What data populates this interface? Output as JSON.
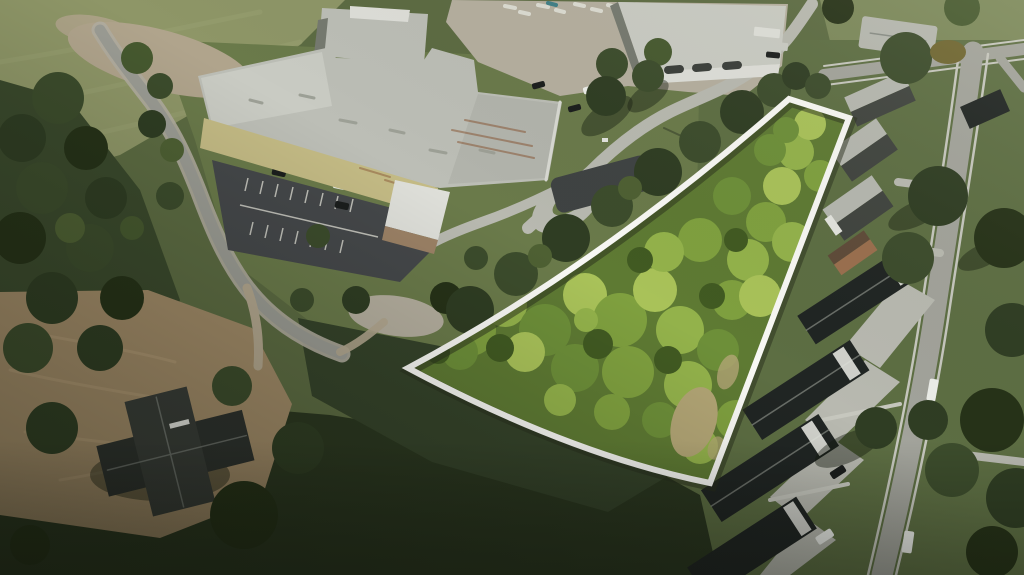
{
  "scene": {
    "kind": "aerial-drone-photograph",
    "subject": "vacant-wooded-land-parcel-with-surveyed-boundary-overlay",
    "boundary_shape": "wedge-quadrilateral",
    "boundary_color": "#f8f8f4",
    "surroundings": [
      "industrial-facility",
      "parking-lot",
      "residential-street",
      "townhome-rows",
      "church-building",
      "forest",
      "dirt-lot",
      "country-road"
    ]
  },
  "palette": {
    "base": "#5c6b42",
    "field": "#8e9667",
    "field-2": "#7b885a",
    "lawn": "#6a7a4a",
    "lawn-2": "#5d6e43",
    "forest": "#3a492c",
    "forest-dark": "#2b3720",
    "forest-mid": "#35432a",
    "dirt": "#a08a67",
    "staging": "#b0a48c",
    "gravel": "#b5af9f",
    "road": "#9b9c94",
    "shoulder": "#b1ada0",
    "street": "#a2a39b",
    "sidewalk": "#c6c7be",
    "driveway": "#b8b9b0",
    "gravel-road": "#b3a78f",
    "asphalt": "#45484a",
    "asphalt-new": "#3f4343",
    "paint-white": "#dcdcd2",
    "roof": "#bcbeb6",
    "roof-light": "#c9cbc3",
    "roof-mid": "#b2b4ac",
    "roof-white": "#dedfd9",
    "face": "#75796f",
    "wall-yellow": "#c4bb85",
    "wall-tan": "#9c8266",
    "dark-roof": "#202523",
    "house-roof-light": "#b5b7af",
    "house-roof-dark": "#40443f",
    "brick-wall": "#9a6f4e",
    "brick-roof": "#5f4b39",
    "church-roof": "#2d312d",
    "church-roof-2": "#383c37",
    "white-trim": "#e3e4de",
    "ridge": "#878c85",
    "vent": "#9da096",
    "car-white": "#eceee9",
    "car-black": "#1b1e1d",
    "car-red": "#7c241f",
    "rust": "#8a5a38",
    "parcel-base": "#5e7a33",
    "p1": "#7fa03f",
    "p2": "#93b24b",
    "p3": "#a9c259",
    "p4": "#6d8f39",
    "p5": "#415a22",
    "clearing": "#b2a575",
    "t1": "#3c4c2c",
    "t2": "#2f3d23",
    "t3": "#46592f",
    "t4": "#263218",
    "t5": "#4e6033",
    "t7": "#6f6631",
    "shadow": "rgba(20,26,14,0.42)",
    "boundary": "#f8f8f4",
    "boundary-shadow": "rgba(40,46,28,0.5)",
    "field-stripe": "#9aa273",
    "dirt-stripe": "#b59d79",
    "pole-shadow": "#2e3524"
  }
}
